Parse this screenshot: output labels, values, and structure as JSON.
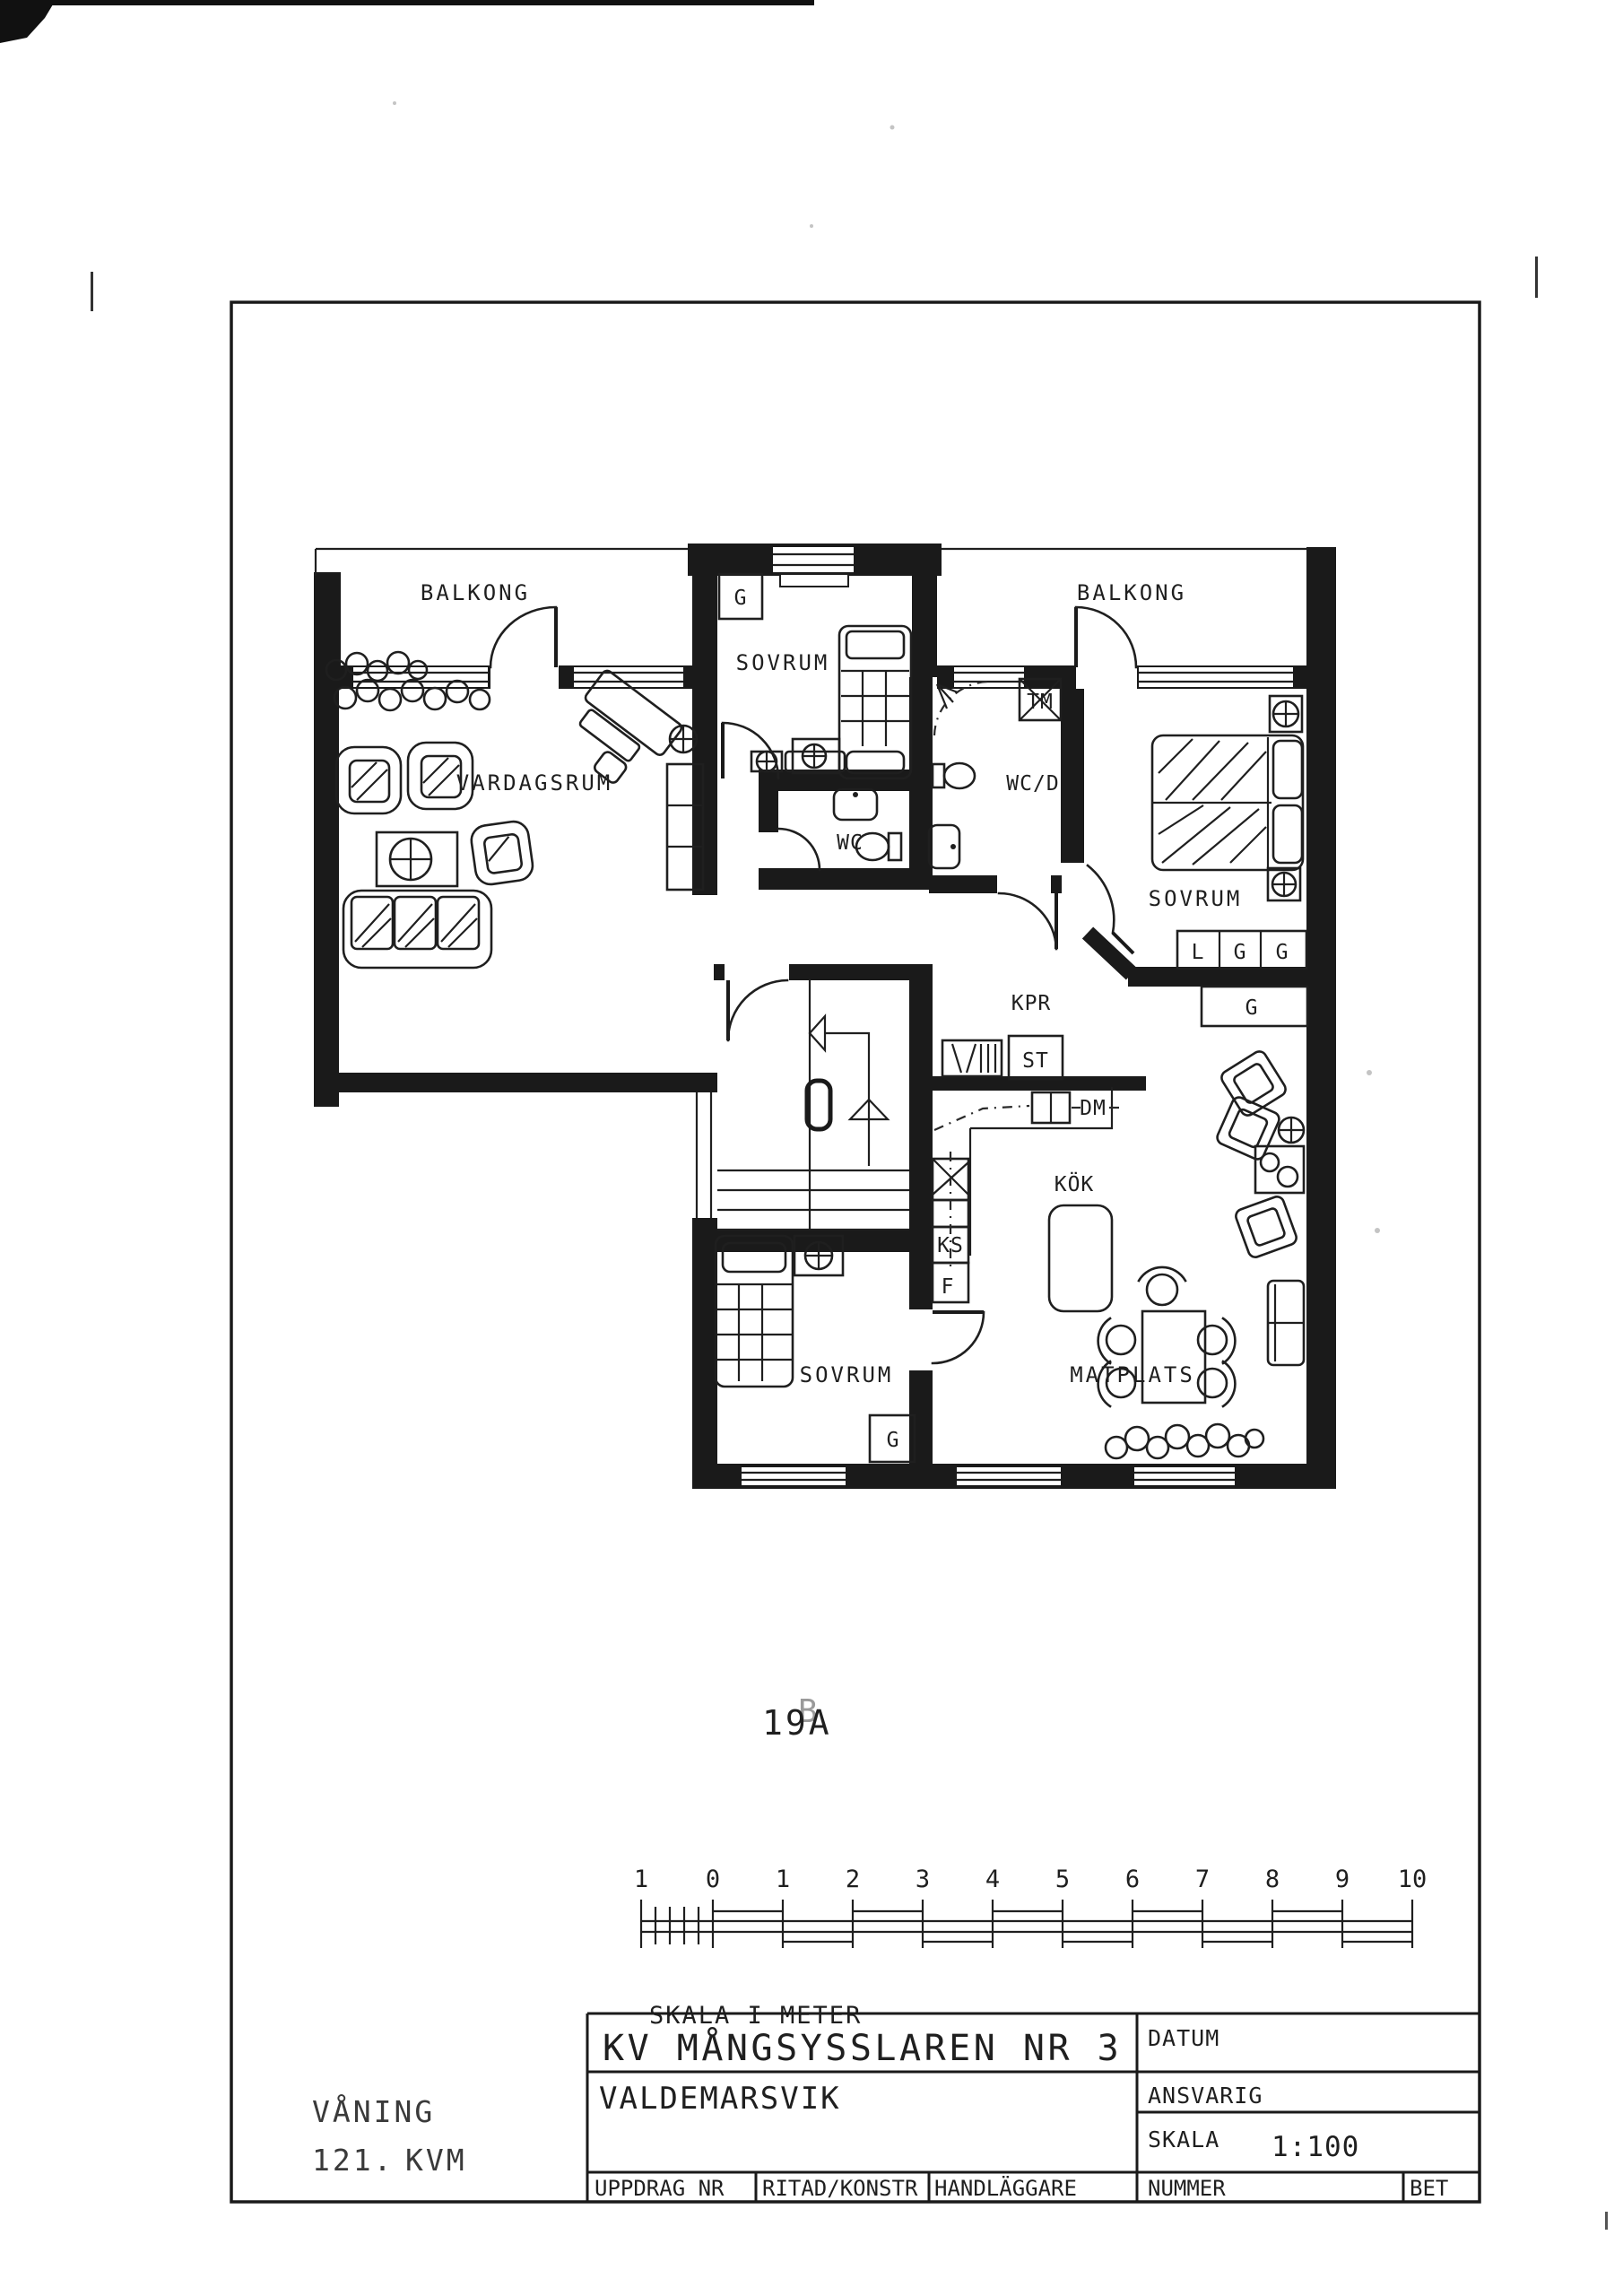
{
  "plan": {
    "number": "19A",
    "number_overlay": "B",
    "labels": {
      "balkong_left": "BALKONG",
      "balkong_right": "BALKONG",
      "vardagsrum": "VARDAGSRUM",
      "sovrum_top": "SOVRUM",
      "sovrum_right": "SOVRUM",
      "sovrum_bottom": "SOVRUM",
      "wc": "WC",
      "wc_d": "WC/D",
      "tm": "TM",
      "kpr": "KPR",
      "st": "ST",
      "dm": "DM",
      "kok": "KÖK",
      "ks": "KS",
      "f": "F",
      "matplats": "MATPLATS",
      "l_wardrobe": "L",
      "g_closet_top": "G",
      "g_wardrobe_1": "G",
      "g_wardrobe_2": "G",
      "g_hall": "G",
      "g_bottom": "G"
    }
  },
  "scale_bar": {
    "caption": "SKALA I METER",
    "ticks": [
      "1",
      "0",
      "1",
      "2",
      "3",
      "4",
      "5",
      "6",
      "7",
      "8",
      "9",
      "10"
    ]
  },
  "title_block": {
    "project": "KV MÅNGSYSSLAREN NR 3",
    "location": "VALDEMARSVIK",
    "datum_label": "DATUM",
    "ansvarig_label": "ANSVARIG",
    "skala_label": "SKALA",
    "skala_value": "1:100",
    "uppdrag_nr_label": "UPPDRAG NR",
    "ritad_konstr_label": "RITAD/KONSTR",
    "handlaggare_label": "HANDLÄGGARE",
    "nummer_label": "NUMMER",
    "bet_label": "BET"
  },
  "margin_note": {
    "line1": "VÅNING",
    "area": "121.",
    "unit": "KVM"
  }
}
